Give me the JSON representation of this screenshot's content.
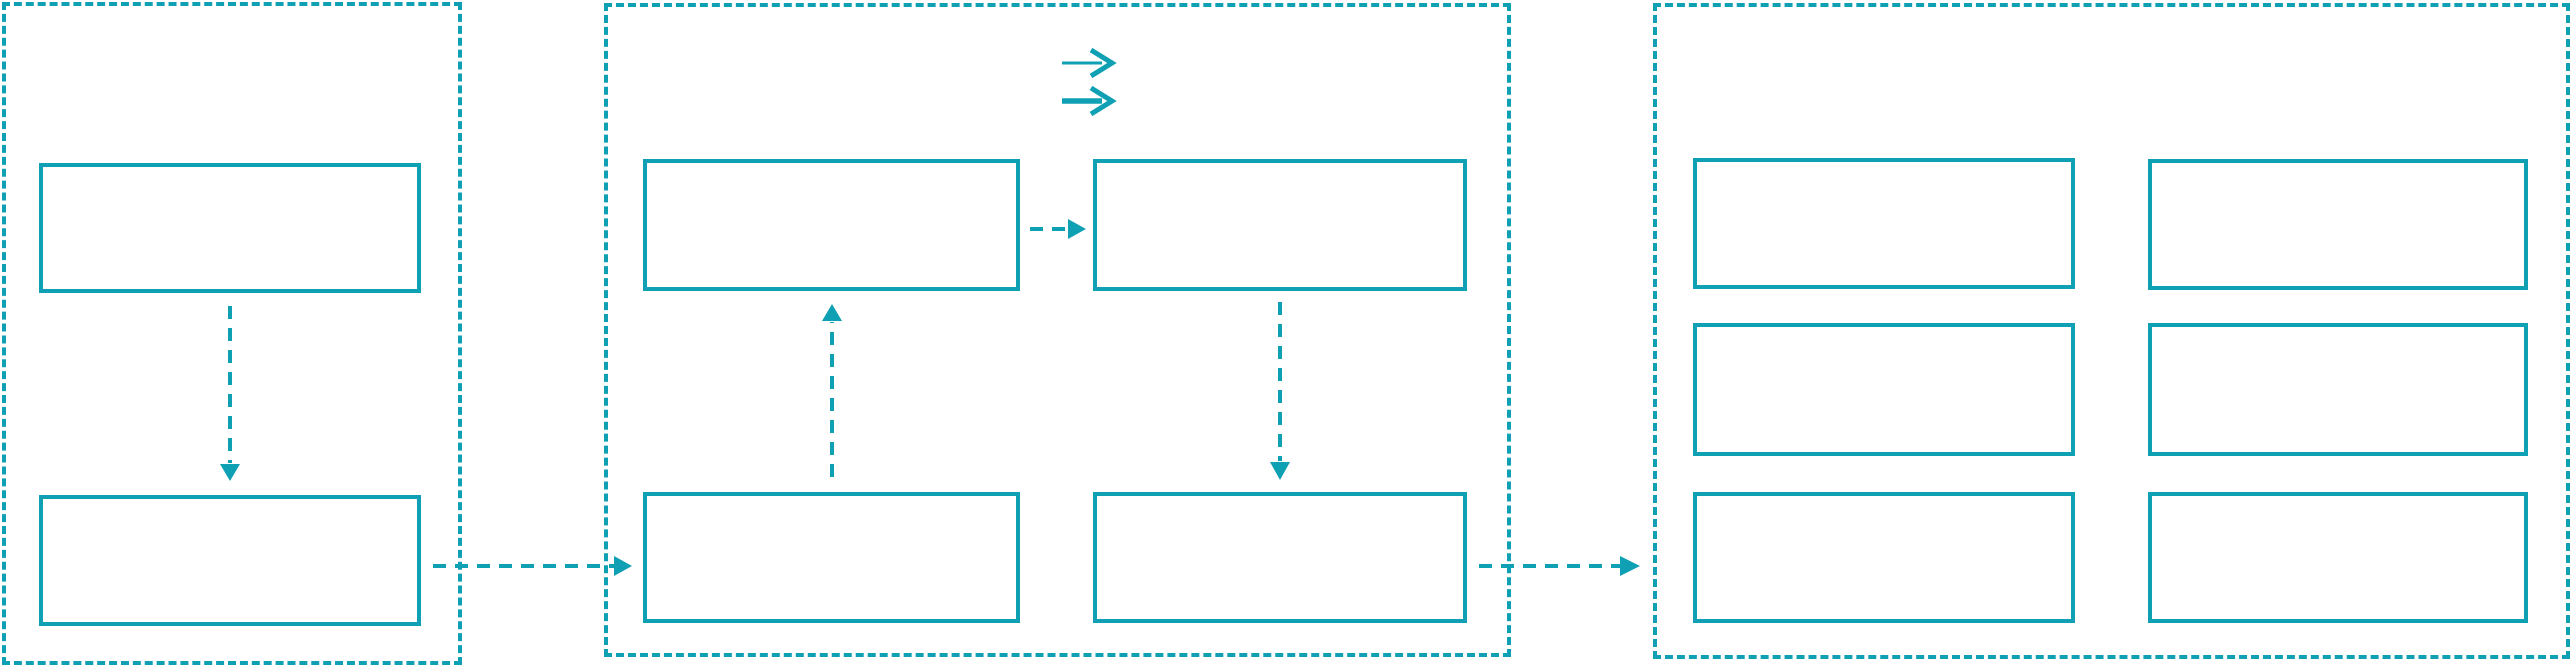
{
  "meta": {
    "kind": "flow-diagram",
    "description": "Three dashed stage containers with empty rectangular nodes linked by dashed arrows; no visible text labels"
  },
  "colors": {
    "accent": "#0fa0b4",
    "canvas": "#ffffff"
  },
  "panels": [
    {
      "id": "left-panel",
      "border_style": "dashed",
      "boxes": [
        "left-top-box",
        "left-bottom-box"
      ]
    },
    {
      "id": "middle-panel",
      "border_style": "dashed",
      "legend_icons": [
        "thin-right-arrow-icon",
        "thick-right-arrow-icon"
      ],
      "boxes": [
        "middle-top-left-box",
        "middle-top-right-box",
        "middle-bottom-left-box",
        "middle-bottom-right-box"
      ]
    },
    {
      "id": "right-panel",
      "border_style": "dashed",
      "boxes": [
        "right-box-row1-col1",
        "right-box-row1-col2",
        "right-box-row2-col1",
        "right-box-row2-col2",
        "right-box-row3-col1",
        "right-box-row3-col2"
      ]
    }
  ],
  "connectors": [
    {
      "id": "left-top-to-left-bottom",
      "style": "dashed",
      "direction": "down",
      "from": "left-top-box",
      "to": "left-bottom-box"
    },
    {
      "id": "left-to-middle",
      "style": "dashed",
      "direction": "right",
      "from": "left-bottom-box",
      "to": "middle-bottom-left-box"
    },
    {
      "id": "middle-topleft-to-topright",
      "style": "dashed",
      "direction": "right",
      "from": "middle-top-left-box",
      "to": "middle-top-right-box"
    },
    {
      "id": "middle-bottomleft-to-topleft",
      "style": "dashed",
      "direction": "up",
      "from": "middle-bottom-left-box",
      "to": "middle-top-left-box"
    },
    {
      "id": "middle-topright-to-bottomright",
      "style": "dashed",
      "direction": "down",
      "from": "middle-top-right-box",
      "to": "middle-bottom-right-box"
    },
    {
      "id": "middle-to-right",
      "style": "dashed",
      "direction": "right",
      "from": "middle-bottom-right-box",
      "to": "right-panel"
    }
  ]
}
